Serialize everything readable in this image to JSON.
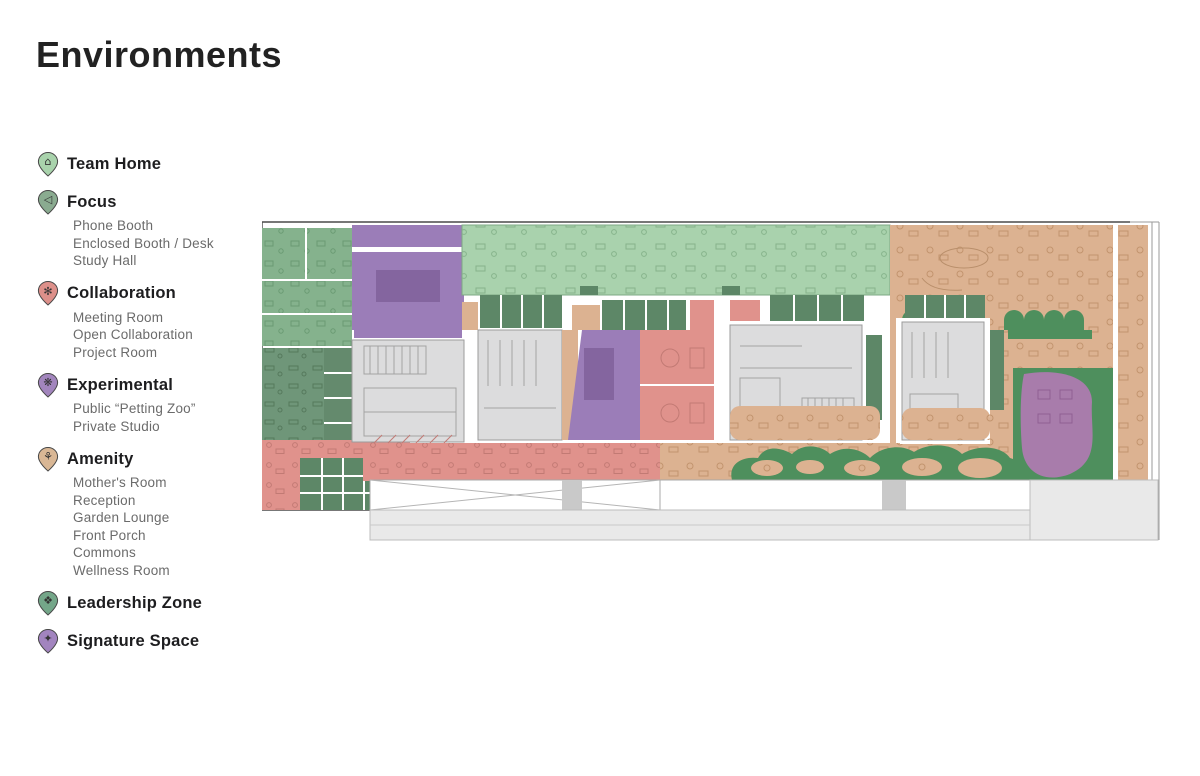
{
  "page": {
    "title": "Environments",
    "background": "#ffffff"
  },
  "legend": {
    "items": [
      {
        "id": "team-home",
        "label": "Team Home",
        "icon": {
          "name": "team-home-pin-icon",
          "glyph": "⌂",
          "color": "#a9d3ac"
        },
        "sub_items": []
      },
      {
        "id": "focus",
        "label": "Focus",
        "icon": {
          "name": "focus-pin-icon",
          "glyph": "◁",
          "color": "#8aab90"
        },
        "sub_items": [
          "Phone Booth",
          "Enclosed Booth / Desk",
          "Study Hall"
        ]
      },
      {
        "id": "collaboration",
        "label": "Collaboration",
        "icon": {
          "name": "collaboration-pin-icon",
          "glyph": "✻",
          "color": "#dd908a"
        },
        "sub_items": [
          "Meeting Room",
          "Open Collaboration",
          "Project Room"
        ]
      },
      {
        "id": "experimental",
        "label": "Experimental",
        "icon": {
          "name": "experimental-pin-icon",
          "glyph": "❋",
          "color": "#a285bd"
        },
        "sub_items": [
          "Public “Petting Zoo”",
          "Private Studio"
        ]
      },
      {
        "id": "amenity",
        "label": "Amenity",
        "icon": {
          "name": "amenity-pin-icon",
          "glyph": "⚘",
          "color": "#d9b795"
        },
        "sub_items": [
          "Mother's Room",
          "Reception",
          "Garden Lounge",
          "Front Porch",
          "Commons",
          "Wellness Room"
        ]
      },
      {
        "id": "leadership-zone",
        "label": "Leadership Zone",
        "icon": {
          "name": "leadership-pin-icon",
          "glyph": "❖",
          "color": "#74a689"
        },
        "sub_items": []
      },
      {
        "id": "signature-space",
        "label": "Signature Space",
        "icon": {
          "name": "signature-pin-icon",
          "glyph": "✦",
          "color": "#a284bf"
        },
        "sub_items": []
      }
    ]
  },
  "floor_plan": {
    "description": "Color-coded office floor plan showing environment zoning",
    "zones": [
      {
        "area": "top-left-offices",
        "type": "team-home",
        "color": "#85b28d"
      },
      {
        "area": "open-office-band",
        "type": "team-home",
        "color": "#a9d2ad"
      },
      {
        "area": "study-hall",
        "type": "focus",
        "color": "#6f9679"
      },
      {
        "area": "phone-booth-grid",
        "type": "focus",
        "color": "#5d8767"
      },
      {
        "area": "enclosed-booths",
        "type": "focus",
        "color": "#5d8767"
      },
      {
        "area": "meeting-rooms",
        "type": "collaboration",
        "color": "#e0928c"
      },
      {
        "area": "open-collaboration-strip",
        "type": "collaboration",
        "color": "#e0928c"
      },
      {
        "area": "petting-zoo",
        "type": "experimental",
        "color": "#9b7db8"
      },
      {
        "area": "private-studio",
        "type": "experimental",
        "color": "#9b7db8"
      },
      {
        "area": "commons-cafe",
        "type": "amenity",
        "color": "#dcb291"
      },
      {
        "area": "front-porch-terrace",
        "type": "amenity",
        "color": "#dcb291"
      },
      {
        "area": "garden-lounge",
        "type": "amenity",
        "color": "#4e8f5d"
      },
      {
        "area": "signature-space",
        "type": "signature",
        "color": "#a87cab"
      },
      {
        "area": "building-core",
        "type": "core",
        "color": "#dcdcdd"
      },
      {
        "area": "exterior-pavement",
        "type": "exterior",
        "color": "#e9e9e9"
      }
    ]
  }
}
